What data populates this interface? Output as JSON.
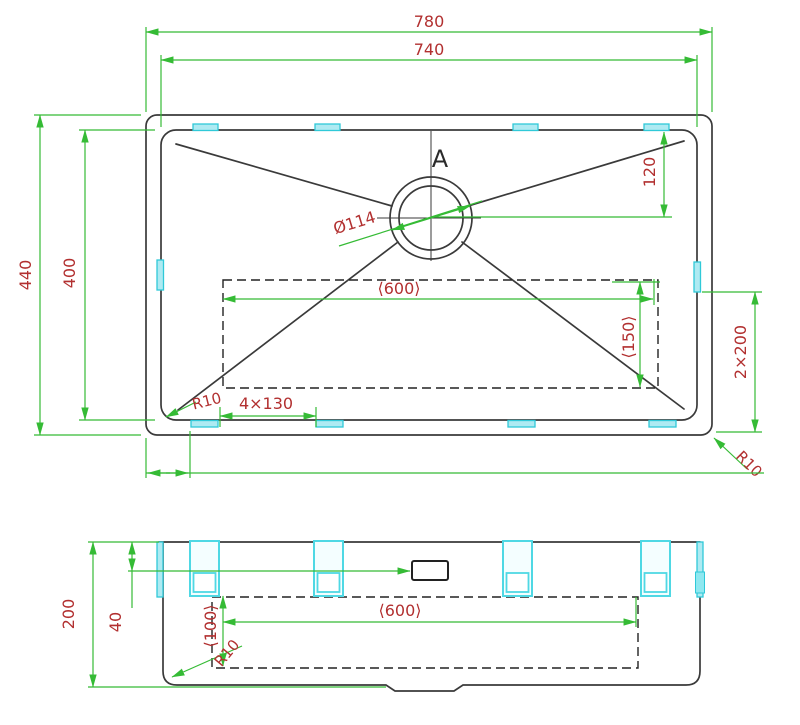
{
  "page": {
    "background": "#ffffff",
    "description": "CAD dimension drawing of undermount kitchen sink, top view and front section view"
  },
  "colors": {
    "outline": "#3a3a3a",
    "hidden_line": "#222222",
    "dimension_line": "#35bb35",
    "dimension_text": "#b23030",
    "clip_stroke": "#2fc9d8",
    "clip_fill": "#aeeaf2"
  },
  "top_view": {
    "section_marker": "A",
    "dims": {
      "overall_width": "780",
      "rim_width": "740",
      "overall_depth": "440",
      "rim_depth": "400",
      "drain_offset": "120",
      "drain_diameter": "Ø114",
      "base_width": "⟨600⟩",
      "base_depth": "⟨150⟩",
      "side_clip_spacing": "2×200",
      "inner_corner_radius": "R10",
      "clip_pitch": "4×130",
      "outer_corner_radius": "R10"
    }
  },
  "side_view": {
    "dims": {
      "overall_height": "200",
      "flange_offset": "40",
      "base_width": "⟨600⟩",
      "base_offset": "⟨100⟩",
      "corner_radius": "R10"
    }
  }
}
